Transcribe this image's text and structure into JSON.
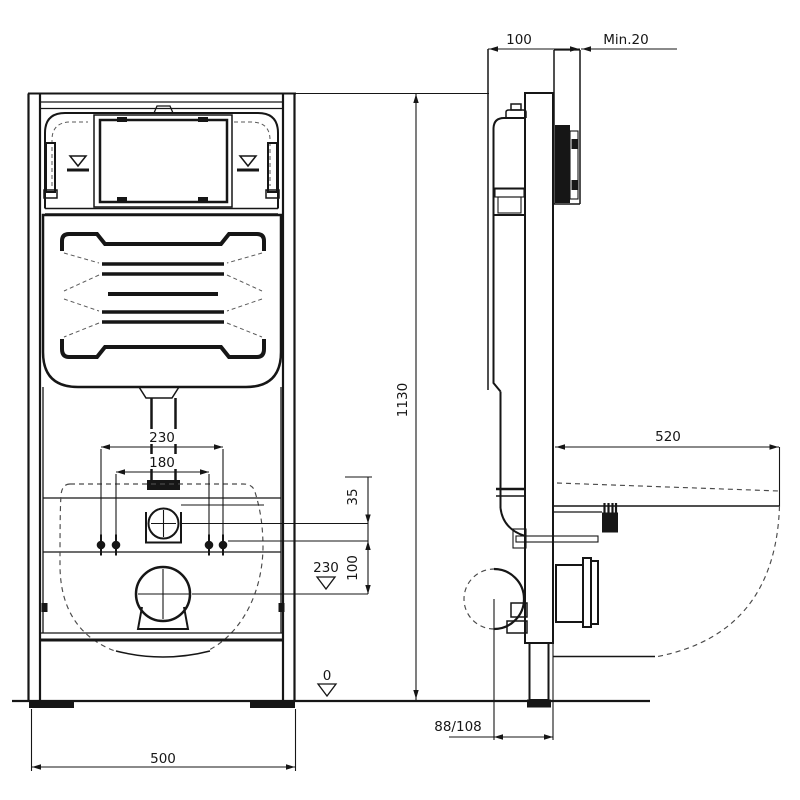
{
  "colors": {
    "line": "#161616",
    "background": "#ffffff"
  },
  "front_view": {
    "height": "1130",
    "width": "500",
    "bolt_spacing_outer": "230",
    "bolt_spacing_inner": "180",
    "elbow_to_bolts": "35",
    "bolts_to_drain": "100",
    "drain_level": "230",
    "floor_level": "0"
  },
  "side_view": {
    "frame_depth": "100",
    "min_wall_cover": "Min.20",
    "bowl_projection": "520",
    "drain_wall_offset": "88/108"
  }
}
